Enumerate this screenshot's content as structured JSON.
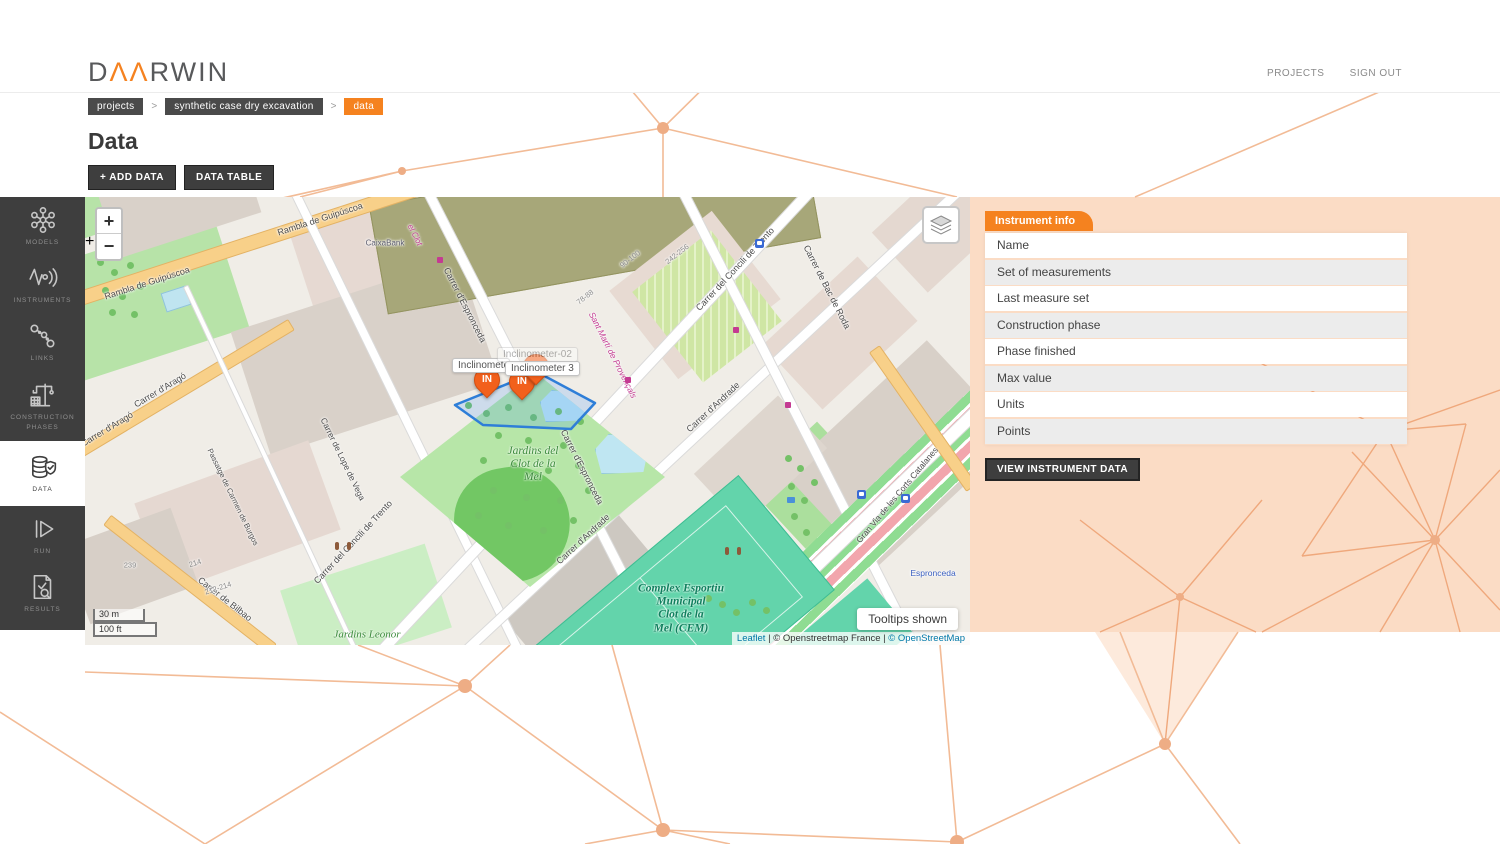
{
  "header": {
    "logo_d": "D",
    "logo_aa": "ΛΛ",
    "logo_rest": "RWIN",
    "nav": {
      "projects": "PROJECTS",
      "signout": "SIGN OUT"
    }
  },
  "breadcrumb": {
    "separator": ">",
    "items": {
      "projects": "projects",
      "project": "synthetic case dry excavation",
      "current": "data"
    }
  },
  "page": {
    "title": "Data",
    "add_data": "+ ADD DATA",
    "data_table": "DATA TABLE"
  },
  "sidebar": {
    "items": [
      {
        "label": "MODELS",
        "icon": "network-icon"
      },
      {
        "label": "INSTRUMENTS",
        "icon": "waveform-icon"
      },
      {
        "label": "LINKS",
        "icon": "chain-nodes-icon"
      },
      {
        "label": "CONSTRUCTION PHASES",
        "icon": "crane-icon"
      },
      {
        "label": "DATA",
        "icon": "database-shield-icon"
      },
      {
        "label": "RUN",
        "icon": "play-icon"
      },
      {
        "label": "RESULTS",
        "icon": "report-check-icon"
      }
    ]
  },
  "panel": {
    "title": "Instrument info",
    "rows": [
      "Name",
      "Set of measurements",
      "Last measure set",
      "Construction phase",
      "Phase finished",
      "Max value",
      "Units",
      "Points"
    ],
    "button": "VIEW INSTRUMENT DATA"
  },
  "map": {
    "zoom_in": "+",
    "zoom_out": "−",
    "tooltips_toggle": "Tooltips shown",
    "scale": {
      "metric": "30 m",
      "imperial": "100 ft"
    },
    "attribution": {
      "leaflet": "Leaflet",
      "sep1": " | ",
      "osm_france": "© Openstreetmap France",
      "sep2": " | ",
      "osm": "© OpenStreetMap"
    },
    "markers": [
      {
        "label": "IN",
        "x": 389,
        "y": 170
      },
      {
        "label": "IN",
        "x": 424,
        "y": 172
      },
      {
        "label": "IN",
        "x": 438,
        "y": 157
      }
    ],
    "tooltips": [
      {
        "t": "Inclinometer 1",
        "x": 367,
        "y": 161,
        "w": 58
      },
      {
        "t": "Inclinometer 3",
        "x": 420,
        "y": 164
      },
      {
        "t": "Inclinometer-02",
        "x": 412,
        "y": 150,
        "o": 0.45
      }
    ],
    "labels": [
      {
        "t": "Rambla de Guipúscoa",
        "x": 62,
        "y": 86,
        "r": -18
      },
      {
        "t": "Rambla de Guipúscoa",
        "x": 235,
        "y": 22,
        "r": -18
      },
      {
        "t": "Carrer d'Aragó",
        "x": 22,
        "y": 232,
        "r": -31
      },
      {
        "t": "Carrer d'Aragó",
        "x": 75,
        "y": 193,
        "r": -31
      },
      {
        "t": "Carrer de Lope de Vega",
        "x": 258,
        "y": 262,
        "r": 64,
        "s": 8.5
      },
      {
        "t": "Passatge de Carmen de Burgos",
        "x": 148,
        "y": 300,
        "r": 64,
        "s": 7.5
      },
      {
        "t": "Carrer de Bilbao",
        "x": 140,
        "y": 402,
        "r": 38
      },
      {
        "t": "Carrer del Concili de Trento",
        "x": 268,
        "y": 345,
        "r": -47
      },
      {
        "t": "Carrer del Concili de Trento",
        "x": 650,
        "y": 72,
        "r": -47
      },
      {
        "t": "Carrer d'Andrade",
        "x": 628,
        "y": 210,
        "r": -43
      },
      {
        "t": "Carrer d'Andrade",
        "x": 498,
        "y": 342,
        "r": -43
      },
      {
        "t": "Carrer d'Espronceda",
        "x": 380,
        "y": 108,
        "r": 63
      },
      {
        "t": "Carrer d'Espronceda",
        "x": 497,
        "y": 270,
        "r": 63
      },
      {
        "t": "Carrer de Bac de Roda",
        "x": 742,
        "y": 90,
        "r": 63
      },
      {
        "t": "Gran Via de les Corts Catalanes",
        "x": 812,
        "y": 298,
        "r": -50,
        "s": 8.5
      },
      {
        "t": "Sant Martí de Provençals",
        "x": 528,
        "y": 158,
        "r": 63,
        "c": "#c43a92",
        "s": 8.5,
        "i": 1
      },
      {
        "t": "el Clot",
        "x": 330,
        "y": 38,
        "r": 63,
        "c": "#c43a92",
        "s": 8,
        "i": 1
      },
      {
        "t": "Espronceda",
        "x": 848,
        "y": 376,
        "r": 0,
        "c": "#3a5fc0",
        "s": 8.5
      },
      {
        "t": "CaixaBank",
        "x": 300,
        "y": 46,
        "r": 0,
        "c": "#5c5c6e",
        "s": 8
      },
      {
        "t": "90-100",
        "x": 545,
        "y": 62,
        "r": -38,
        "c": "#8a8a8a",
        "s": 7.5
      },
      {
        "t": "78-88",
        "x": 500,
        "y": 100,
        "r": -38,
        "c": "#8a8a8a",
        "s": 7.5
      },
      {
        "t": "242-256",
        "x": 592,
        "y": 57,
        "r": -38,
        "c": "#8a8a8a",
        "s": 7.5
      },
      {
        "t": "212-214",
        "x": 133,
        "y": 391,
        "r": -18,
        "c": "#8a8a8a",
        "s": 7.5
      },
      {
        "t": "214",
        "x": 110,
        "y": 366,
        "r": -18,
        "c": "#8a8a8a",
        "s": 7.5
      },
      {
        "t": "239",
        "x": 45,
        "y": 368,
        "r": 0,
        "c": "#8a8a8a",
        "s": 7.5
      }
    ],
    "area_labels": [
      {
        "t": "Jardins del\nClot de la\nMel",
        "x": 448,
        "y": 268,
        "c": "#3d8b3d",
        "s": 11.5
      },
      {
        "t": "Jardins Leonor",
        "x": 282,
        "y": 438,
        "c": "#3d8b3d",
        "s": 11
      },
      {
        "t": "Complex Esportiu\nMunicipal\nClot de la\nMel (CEM)",
        "x": 596,
        "y": 412,
        "c": "#0e7f5d",
        "s": 11.5,
        "b": 1
      }
    ],
    "pois": [
      {
        "k": "hospital",
        "x": 200,
        "y": 342,
        "t": "H"
      },
      {
        "k": "pharmacy",
        "x": 258,
        "y": 222,
        "t": "+"
      },
      {
        "k": "pharmacy",
        "x": 652,
        "y": 24,
        "t": "+"
      },
      {
        "k": "bus",
        "x": 772,
        "y": 293
      },
      {
        "k": "bus",
        "x": 816,
        "y": 297
      },
      {
        "k": "bus",
        "x": 670,
        "y": 42
      },
      {
        "k": "shop",
        "x": 352,
        "y": 60
      },
      {
        "k": "shop",
        "x": 455,
        "y": 168
      },
      {
        "k": "shop",
        "x": 648,
        "y": 130
      },
      {
        "k": "shop",
        "x": 700,
        "y": 205
      },
      {
        "k": "shop",
        "x": 540,
        "y": 180
      },
      {
        "k": "person",
        "x": 250,
        "y": 345
      },
      {
        "k": "person",
        "x": 262,
        "y": 345
      },
      {
        "k": "person",
        "x": 640,
        "y": 350
      },
      {
        "k": "person",
        "x": 652,
        "y": 350
      },
      {
        "k": "fountain",
        "x": 702,
        "y": 300
      }
    ]
  }
}
